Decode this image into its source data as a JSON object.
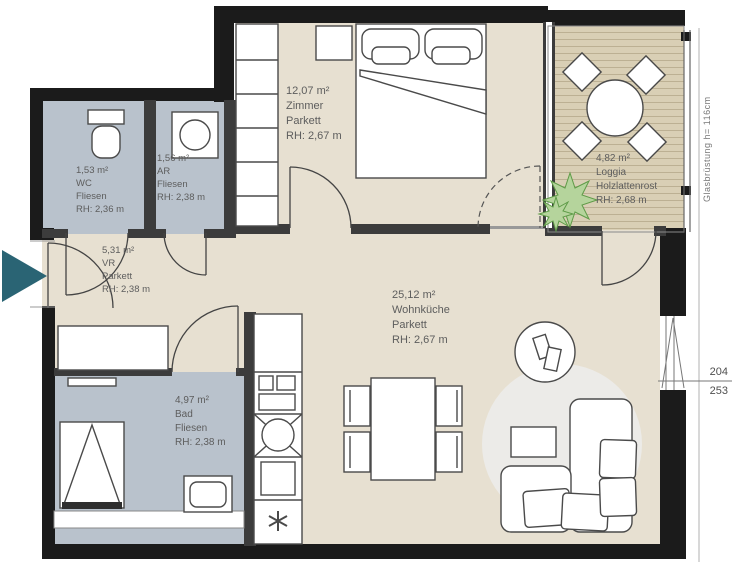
{
  "plan": {
    "rooms": {
      "wc": {
        "area": "1,53 m²",
        "name": "WC",
        "floor": "Fliesen",
        "rh": "RH: 2,36 m"
      },
      "ar": {
        "area": "1,56 m²",
        "name": "AR",
        "floor": "Fliesen",
        "rh": "RH: 2,38 m"
      },
      "vr": {
        "area": "5,31 m²",
        "name": "VR",
        "floor": "Parkett",
        "rh": "RH: 2,38 m"
      },
      "zimmer": {
        "area": "12,07 m²",
        "name": "Zimmer",
        "floor": "Parkett",
        "rh": "RH: 2,67 m"
      },
      "loggia": {
        "area": "4,82 m²",
        "name": "Loggia",
        "floor": "Holzlattenrost",
        "rh": "RH: 2,68 m"
      },
      "wohnkueche": {
        "area": "25,12 m²",
        "name": "Wohnküche",
        "floor": "Parkett",
        "rh": "RH: 2,67 m"
      },
      "bad": {
        "area": "4,97 m²",
        "name": "Bad",
        "floor": "Fliesen",
        "rh": "RH: 2,38 m"
      }
    },
    "annotations": {
      "railing_label": "Glasbrüstung h= 116cm",
      "dim_upper": "204",
      "dim_lower": "253"
    },
    "colors": {
      "wall": "#1b1b1b",
      "interior_wall": "#3c3c3c",
      "tile_floor": "#b9c2cc",
      "parquet_floor": "#e7e0d1",
      "wood_deck": "#d9cfb5",
      "deck_line": "#bcb093",
      "rug": "#ecebe8",
      "entrance_arrow": "#2a6474",
      "label_text": "#5d5d5d",
      "furniture_line": "#4a4a4a"
    }
  }
}
